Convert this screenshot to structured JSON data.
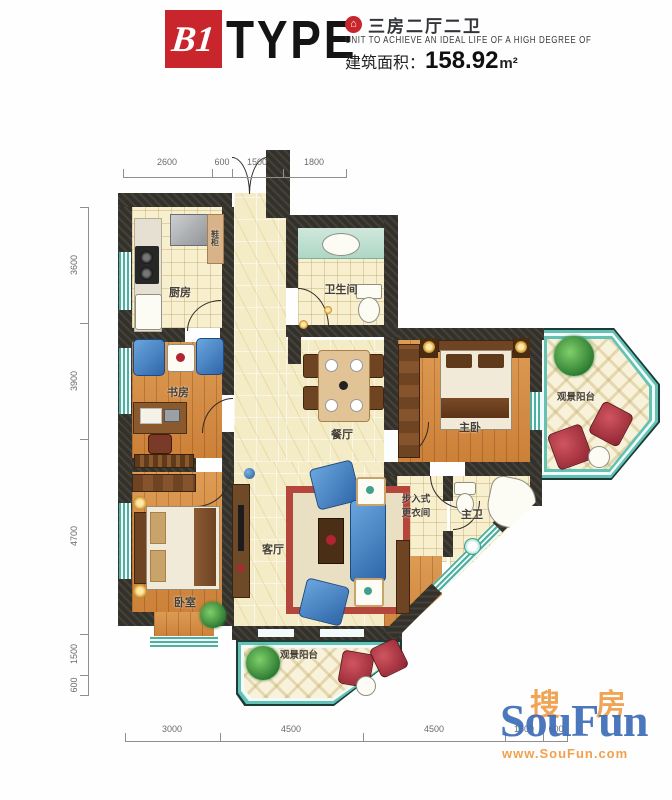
{
  "header": {
    "type_code": "B1",
    "type_word": "TYPE",
    "house_icon_glyph": "⌂",
    "unit_layout": "三房二厅二卫",
    "tagline": "UNIT TO ACHIEVE AN IDEAL LIFE OF A HIGH DEGREE OF",
    "area_label": "建筑面积：",
    "area_value": "158.92",
    "area_unit": "m²"
  },
  "rooms": {
    "kitchen": "厨房",
    "shoe_cabinet": "鞋柜",
    "guest_bath": "卫生间",
    "study": "书房",
    "dining": "餐厅",
    "master_bedroom": "主卧",
    "balcony_top": "观景阳台",
    "closet_line1": "步入式",
    "closet_line2": "更衣间",
    "master_bath": "主卫",
    "living": "客厅",
    "bedroom": "卧室",
    "balcony_bottom": "观景阳台"
  },
  "dimensions": {
    "top": [
      "2600",
      "600",
      "1500",
      "1800"
    ],
    "left": [
      "3600",
      "3900",
      "4700",
      "1500",
      "600"
    ],
    "bottom": [
      "3000",
      "4500",
      "4500",
      "1500",
      "600"
    ]
  },
  "watermark": {
    "cn_char1": "搜",
    "cn_char2": "房",
    "brand": "SouFun",
    "url": "www.SouFun.com"
  },
  "colors": {
    "accent_red": "#c8252c",
    "wall": "#33312a",
    "window_teal": "#4fae9f",
    "wood": "#d69148",
    "marble": "#f4ecc6",
    "balcony_frame": "#63c2b4",
    "sofa_blue": "#3f7fc4",
    "chair_red": "#a83240",
    "watermark_blue": "#3e6db8",
    "watermark_orange": "#f0a14e"
  }
}
